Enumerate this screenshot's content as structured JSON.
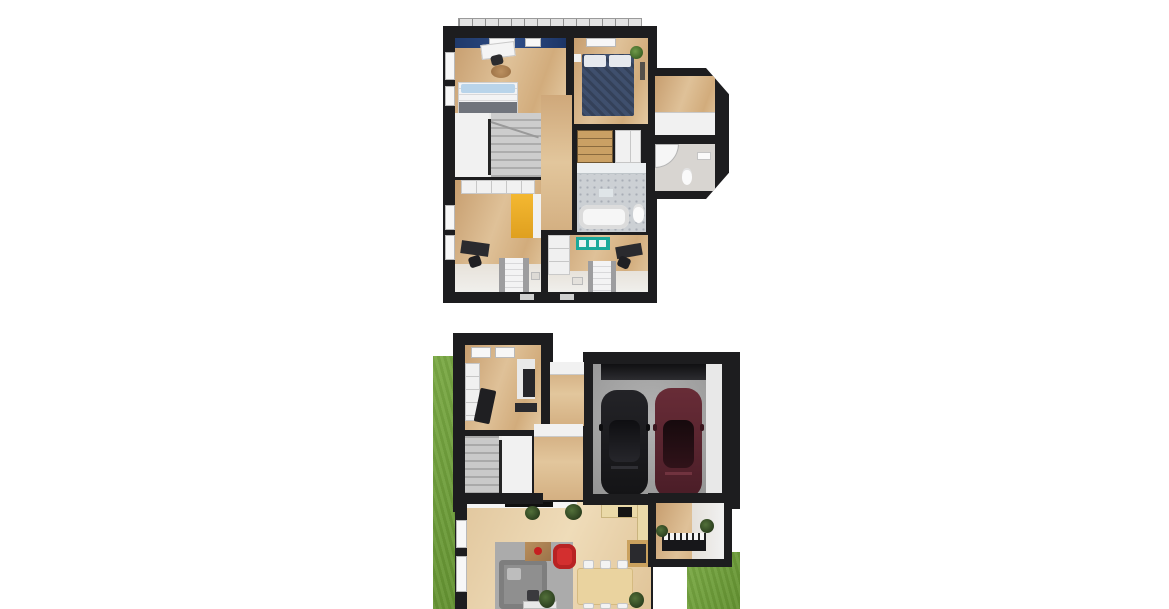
{
  "scene": {
    "kind": "3d-architectural-floor-plan-render",
    "text_visible": "none",
    "floors": [
      {
        "id": "upper-floor",
        "rooms": [
          {
            "name": "bedroom-master-left",
            "furniture": [
              "desk",
              "desk-chair",
              "round-rug",
              "double-bed-blue-pillows",
              "blue-accent-wall",
              "roof-windows"
            ]
          },
          {
            "name": "bedroom-right",
            "furniture": [
              "navy-double-bed",
              "white-pillows",
              "potted-plant",
              "window"
            ]
          },
          {
            "name": "walk-in-closet-extension",
            "furniture": [
              "white-cabinet"
            ]
          },
          {
            "name": "bathroom-extension",
            "furniture": [
              "corner-shower",
              "toilet",
              "sink"
            ]
          },
          {
            "name": "staircase-landing",
            "furniture": [
              "winder-stairs",
              "railing"
            ]
          },
          {
            "name": "hallway",
            "furniture": []
          },
          {
            "name": "linen-closet",
            "furniture": [
              "wood-shelves",
              "white-cabinet"
            ]
          },
          {
            "name": "bathroom-main",
            "furniture": [
              "bathtub",
              "toilet",
              "patterned-tile-floor",
              "shelf"
            ]
          },
          {
            "name": "kids-room-left",
            "furniture": [
              "white-wardrobe",
              "yellow-cabinet",
              "black-desk",
              "desk-chair",
              "single-bed"
            ]
          },
          {
            "name": "kids-room-right",
            "furniture": [
              "white-wardrobe",
              "teal-shelf",
              "black-desk",
              "desk-chair",
              "single-bed"
            ]
          }
        ]
      },
      {
        "id": "ground-floor",
        "rooms": [
          {
            "name": "entry-hall",
            "furniture": [
              "ceiling-lights",
              "white-wardrobe",
              "shoe-bench",
              "coat-rack"
            ]
          },
          {
            "name": "utility-room",
            "furniture": []
          },
          {
            "name": "garage",
            "furniture": [
              "garage-door",
              "black-car",
              "red-car"
            ]
          },
          {
            "name": "staircase",
            "furniture": [
              "winder-stairs"
            ]
          },
          {
            "name": "living-room",
            "furniture": [
              "tv-wall",
              "gray-sofa",
              "red-armchair",
              "coffee-table",
              "gray-rug",
              "potted-plants",
              "windows"
            ]
          },
          {
            "name": "kitchen",
            "furniture": [
              "l-shaped-counter",
              "cooktop",
              "tall-cabinet"
            ]
          },
          {
            "name": "dining-area",
            "furniture": [
              "dining-table",
              "six-chairs",
              "potted-plants"
            ]
          },
          {
            "name": "music-room",
            "furniture": [
              "piano",
              "potted-plants"
            ]
          }
        ],
        "outdoor": [
          "grass-strip-left",
          "grass-patch-bottom-right"
        ]
      }
    ]
  },
  "palette": {
    "wall": "#1d1d1f",
    "wood": "#d9b88c",
    "wood_light": "#e8d5b2",
    "grass": "#74a140",
    "concrete": "#a5a5a5",
    "tile": "#ccd0d4",
    "navy_bed": "#3f4f6d",
    "accent_blue_wall": "#2e4c86",
    "teal_shelf": "#1ba99b",
    "yellow_cabinet": "#f2b02c",
    "red_armchair": "#d32f2f",
    "car_red": "#5e2731",
    "car_black": "#1b1b1e",
    "sofa_gray": "#8f8f8f",
    "white_interior": "#f1f1f1",
    "background": "#ffffff"
  }
}
